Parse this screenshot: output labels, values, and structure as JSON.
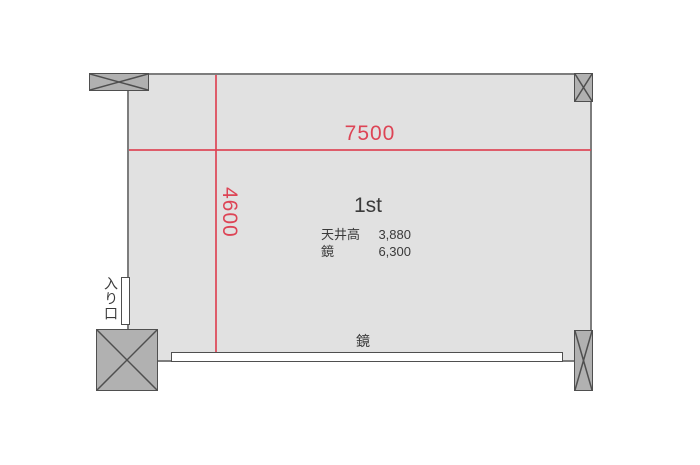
{
  "plan": {
    "room_label": "1st",
    "dimensions": {
      "width_label": "7500",
      "depth_label": "4600"
    },
    "specs": [
      {
        "label": "天井高",
        "value": "3,880"
      },
      {
        "label": "鏡",
        "value": "6,300"
      }
    ],
    "entrance_label": "入り口",
    "mirror_label": "鏡",
    "colors": {
      "dimension_red": "#dd4455",
      "room_fill": "#e1e1e1",
      "column_fill": "#b1b1b1",
      "wall_gray": "#7d7d7d",
      "outline_dark": "#4f4f4f",
      "text_dark": "#3a3a3a"
    }
  }
}
